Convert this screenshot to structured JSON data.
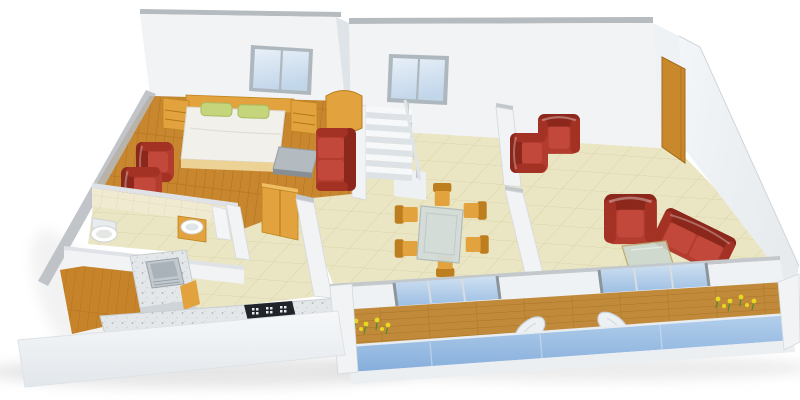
{
  "scene": {
    "type": "3d-floor-plan-render",
    "label": "3D isometric apartment floor plan rendering",
    "rooms": [
      {
        "name": "bedroom",
        "floor": "wood"
      },
      {
        "name": "bathroom",
        "floor": "tile"
      },
      {
        "name": "kitchen",
        "floor": "tile"
      },
      {
        "name": "utility",
        "floor": "wood"
      },
      {
        "name": "dining-area",
        "floor": "tile"
      },
      {
        "name": "living-room",
        "floor": "tile"
      },
      {
        "name": "balcony",
        "floor": "deck"
      }
    ],
    "furniture": [
      "double-bed",
      "bedside-tables",
      "red-armchairs",
      "gray-coffee-table",
      "red-sofas",
      "staircase",
      "curved-wardrobe",
      "hall-closet",
      "toilet",
      "washbasin",
      "kitchen-sink",
      "gas-cooktop",
      "glass-dining-table",
      "wooden-dining-chairs",
      "glass-coffee-table",
      "lounge-chairs",
      "balcony-table",
      "flower-beds",
      "glass-balcony-railing",
      "sliding-glass-doors",
      "entrance-door",
      "windows"
    ]
  },
  "colors": {
    "wall": "#f1f3f5",
    "wallShade": "#dfe4e8",
    "wallCap": "#b6bbc0",
    "wallLt": "#eef2f5",
    "edge": "#ccd1d6",
    "wood": "#c8862e",
    "woodLine": "#aa6f1c",
    "tile": "#eae5c3",
    "tileLine": "#d8d2a6",
    "bathTile": "#f0ead1",
    "bathTileLine": "#ded7b2",
    "deck": "#c08a3a",
    "deckLine": "#a2701f",
    "granite": "#e4e7e9",
    "graniteDot": "#aab1b7",
    "leather": "#b23c2e",
    "leatherDark": "#8c271c",
    "leatherMid": "#a33225",
    "leatherSeat": "#c1483a",
    "furnWood": "#e2a23d",
    "furnWoodDark": "#bd7e1f",
    "pillow": "#c5d57b",
    "mattress": "#f1f0ea",
    "steel": "#c2c9cf",
    "steelDark": "#9aa2a9",
    "stove": "#212529",
    "door": "#c9882c",
    "glassLight": "#e8f0f8",
    "glassDark": "#c2d6ea",
    "railLight": "#b3cfec",
    "railDark": "#86aedb",
    "flower": "#e8d81f",
    "leaf": "#4d8a2f",
    "glassTable": "#ccd8cf",
    "shadow": "#dcdcdc"
  }
}
